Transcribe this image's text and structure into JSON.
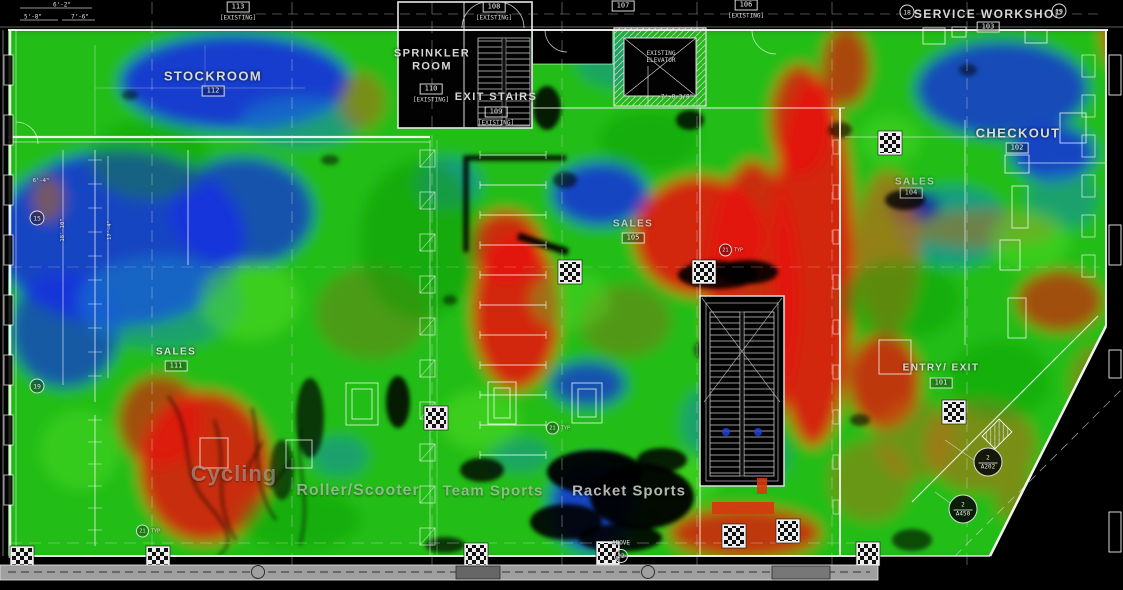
{
  "colors": {
    "background": "#000000",
    "linework": "#ffffff",
    "heat_green": "#20bd12",
    "heat_blue": "#1530e2",
    "heat_teal": "#1585c8",
    "heat_red": "#e61508",
    "heat_orange": "#c2681a",
    "heat_brown": "#8f6a1d"
  },
  "rooms": {
    "stockroom": {
      "name": "STOCKROOM",
      "number": "112"
    },
    "sprinkler": {
      "name": "SPRINKLER ROOM",
      "number": "110",
      "status": "[EXISTING]"
    },
    "exit_stairs": {
      "name": "EXIT STAIRS",
      "number": "109",
      "status": "[EXISTING]"
    },
    "service_workshop": {
      "name": "SERVICE WORKSHOP",
      "number": "103"
    },
    "checkout": {
      "name": "CHECKOUT",
      "number": "102"
    },
    "sales_left": {
      "name": "SALES",
      "number": "111"
    },
    "sales_center": {
      "name": "SALES",
      "number": "105"
    },
    "sales_right": {
      "name": "SALES",
      "number": "104"
    },
    "entry_exit": {
      "name": "ENTRY/ EXIT",
      "number": "101"
    },
    "elevator": {
      "name": "EXISTING ELEVATOR"
    }
  },
  "departments": {
    "cycling": "Cycling",
    "roller": "Roller/Scooter",
    "team": "Team Sports",
    "racket": "Racket Sports"
  },
  "door_tags": {
    "t113": {
      "number": "113",
      "status": "[EXISTING]"
    },
    "t108": {
      "number": "108",
      "status": "[EXISTING]"
    },
    "t107": {
      "number": "107"
    },
    "t106": {
      "number": "106",
      "status": "[EXISTING]"
    }
  },
  "callouts": {
    "c1": {
      "detail": "2",
      "sheet": "A202"
    },
    "c2": {
      "detail": "2",
      "sheet": "A450"
    }
  },
  "dimensions": {
    "d1": "6'-2\"",
    "d2": "5'-8\"",
    "d3": "7'-6\"",
    "d4": "7'-8 3/8\"",
    "d5": "6'-4\"",
    "d6": "18'-10\"",
    "d7": "17'-4\""
  },
  "grid_bubbles": {
    "top1": "18",
    "top2": "19",
    "left1": "15",
    "left2": "19"
  },
  "annotations": {
    "above": "ABOVE",
    "above_num": "22",
    "typ_num": "21",
    "typ": "TYP"
  }
}
